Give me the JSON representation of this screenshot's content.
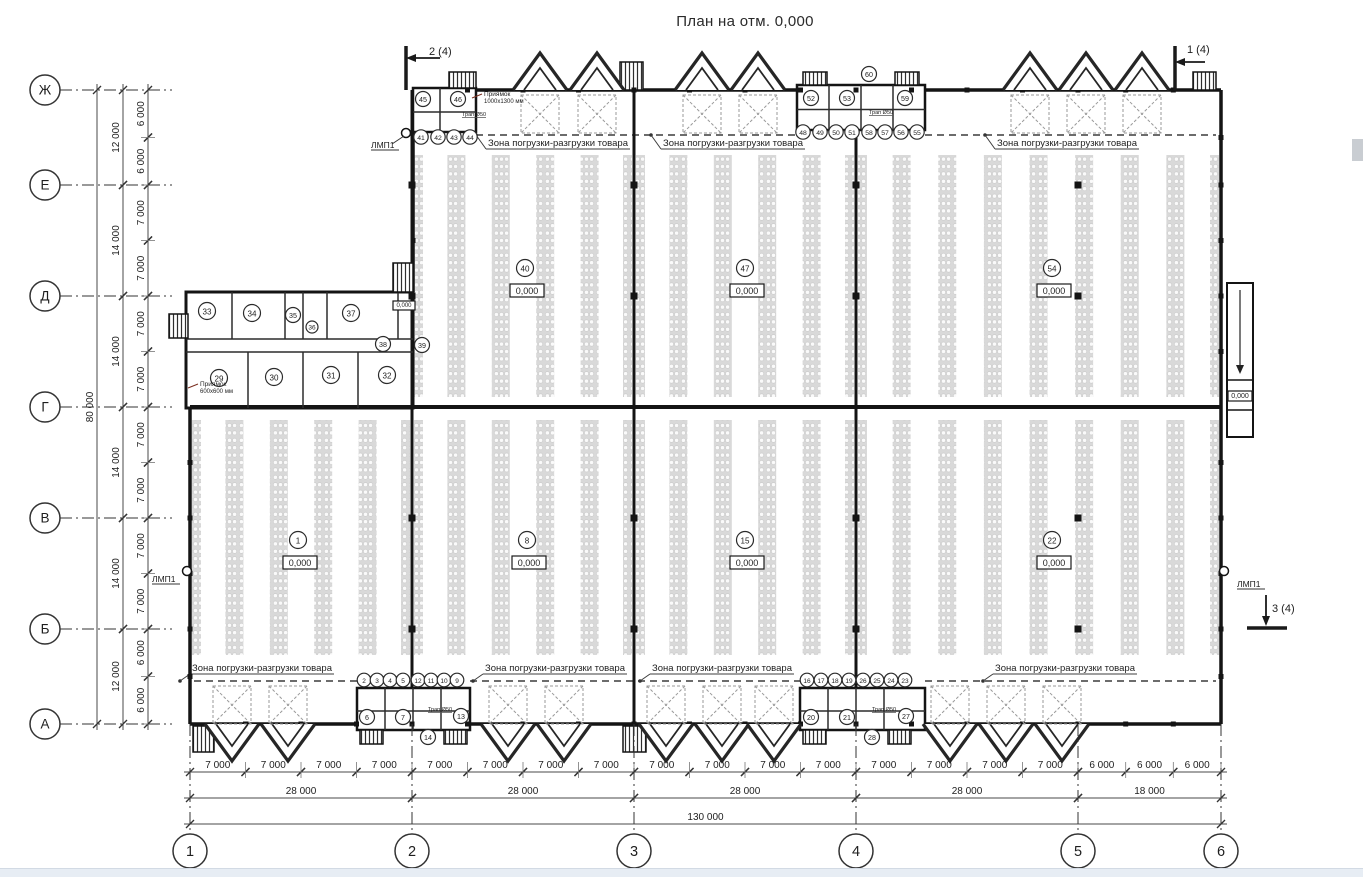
{
  "title": "План на отм. 0,000",
  "zone_label": "Зона погрузки-разгрузки товара",
  "letter_axes": [
    {
      "label": "Ж",
      "y": 90
    },
    {
      "label": "Е",
      "y": 185
    },
    {
      "label": "Д",
      "y": 296
    },
    {
      "label": "Г",
      "y": 407
    },
    {
      "label": "В",
      "y": 518
    },
    {
      "label": "Б",
      "y": 629
    },
    {
      "label": "А",
      "y": 724
    }
  ],
  "number_axes": [
    {
      "label": "1",
      "x": 190
    },
    {
      "label": "2",
      "x": 412
    },
    {
      "label": "3",
      "x": 634
    },
    {
      "label": "4",
      "x": 856
    },
    {
      "label": "5",
      "x": 1078
    },
    {
      "label": "6",
      "x": 1221
    }
  ],
  "dim_left_minor": [
    {
      "text": "6 000",
      "a": 90,
      "b": 137.5
    },
    {
      "text": "6 000",
      "a": 137.5,
      "b": 185
    },
    {
      "text": "7 000",
      "a": 185,
      "b": 240.5
    },
    {
      "text": "7 000",
      "a": 240.5,
      "b": 296
    },
    {
      "text": "7 000",
      "a": 296,
      "b": 351.5
    },
    {
      "text": "7 000",
      "a": 351.5,
      "b": 407
    },
    {
      "text": "7 000",
      "a": 407,
      "b": 462.5
    },
    {
      "text": "7 000",
      "a": 462.5,
      "b": 518
    },
    {
      "text": "7 000",
      "a": 518,
      "b": 573.5
    },
    {
      "text": "7 000",
      "a": 573.5,
      "b": 629
    },
    {
      "text": "6 000",
      "a": 629,
      "b": 676.5
    },
    {
      "text": "6 000",
      "a": 676.5,
      "b": 724
    }
  ],
  "dim_left_major": [
    {
      "text": "12 000",
      "a": 90,
      "b": 185
    },
    {
      "text": "14 000",
      "a": 185,
      "b": 296
    },
    {
      "text": "14 000",
      "a": 296,
      "b": 407
    },
    {
      "text": "14 000",
      "a": 407,
      "b": 518
    },
    {
      "text": "14 000",
      "a": 518,
      "b": 629
    },
    {
      "text": "12 000",
      "a": 629,
      "b": 724
    }
  ],
  "dim_left_total": {
    "text": "80 000",
    "a": 90,
    "b": 724
  },
  "dim_bottom_minor": [
    {
      "text": "7 000",
      "a": 190,
      "b": 245.5
    },
    {
      "text": "7 000",
      "a": 245.5,
      "b": 301
    },
    {
      "text": "7 000",
      "a": 301,
      "b": 356.5
    },
    {
      "text": "7 000",
      "a": 356.5,
      "b": 412
    },
    {
      "text": "7 000",
      "a": 412,
      "b": 467.5
    },
    {
      "text": "7 000",
      "a": 467.5,
      "b": 523
    },
    {
      "text": "7 000",
      "a": 523,
      "b": 578.5
    },
    {
      "text": "7 000",
      "a": 578.5,
      "b": 634
    },
    {
      "text": "7 000",
      "a": 634,
      "b": 689.5
    },
    {
      "text": "7 000",
      "a": 689.5,
      "b": 745
    },
    {
      "text": "7 000",
      "a": 745,
      "b": 800.5
    },
    {
      "text": "7 000",
      "a": 800.5,
      "b": 856
    },
    {
      "text": "7 000",
      "a": 856,
      "b": 911.5
    },
    {
      "text": "7 000",
      "a": 911.5,
      "b": 967
    },
    {
      "text": "7 000",
      "a": 967,
      "b": 1022.5
    },
    {
      "text": "7 000",
      "a": 1022.5,
      "b": 1078
    },
    {
      "text": "6 000",
      "a": 1078,
      "b": 1125.7
    },
    {
      "text": "6 000",
      "a": 1125.7,
      "b": 1173.3
    },
    {
      "text": "6 000",
      "a": 1173.3,
      "b": 1221
    }
  ],
  "dim_bottom_major": [
    {
      "text": "28 000",
      "a": 190,
      "b": 412
    },
    {
      "text": "28 000",
      "a": 412,
      "b": 634
    },
    {
      "text": "28 000",
      "a": 634,
      "b": 856
    },
    {
      "text": "28 000",
      "a": 856,
      "b": 1078
    },
    {
      "text": "18 000",
      "a": 1078,
      "b": 1221
    }
  ],
  "dim_bottom_total": {
    "text": "130 000",
    "a": 190,
    "b": 1221
  },
  "zones": [
    {
      "x": 558,
      "y": 146,
      "side": "top"
    },
    {
      "x": 733,
      "y": 146,
      "side": "top"
    },
    {
      "x": 1067,
      "y": 146,
      "side": "top"
    },
    {
      "x": 262,
      "y": 671,
      "side": "bottom"
    },
    {
      "x": 555,
      "y": 671,
      "side": "bottom"
    },
    {
      "x": 722,
      "y": 671,
      "side": "bottom"
    },
    {
      "x": 1065,
      "y": 671,
      "side": "bottom"
    }
  ],
  "rooms": [
    {
      "n": "1",
      "x": 298,
      "y": 540,
      "r": 8.5
    },
    {
      "n": "8",
      "x": 527,
      "y": 540,
      "r": 8.5
    },
    {
      "n": "15",
      "x": 745,
      "y": 540,
      "r": 8.5
    },
    {
      "n": "22",
      "x": 1052,
      "y": 540,
      "r": 8.5
    },
    {
      "n": "40",
      "x": 525,
      "y": 268,
      "r": 8.5
    },
    {
      "n": "47",
      "x": 745,
      "y": 268,
      "r": 8.5
    },
    {
      "n": "54",
      "x": 1052,
      "y": 268,
      "r": 8.5
    },
    {
      "n": "33",
      "x": 207,
      "y": 311,
      "r": 8.5
    },
    {
      "n": "34",
      "x": 252,
      "y": 313,
      "r": 8.5
    },
    {
      "n": "35",
      "x": 293,
      "y": 315,
      "r": 7.5
    },
    {
      "n": "36",
      "x": 312,
      "y": 327,
      "r": 6
    },
    {
      "n": "37",
      "x": 351,
      "y": 313,
      "r": 8.5
    },
    {
      "n": "38",
      "x": 383,
      "y": 344,
      "r": 7.5
    },
    {
      "n": "39",
      "x": 422,
      "y": 345,
      "r": 7.5
    },
    {
      "n": "29",
      "x": 219,
      "y": 378,
      "r": 8.5
    },
    {
      "n": "30",
      "x": 274,
      "y": 377,
      "r": 8.5
    },
    {
      "n": "31",
      "x": 331,
      "y": 375,
      "r": 8.5
    },
    {
      "n": "32",
      "x": 387,
      "y": 375,
      "r": 8.5
    },
    {
      "n": "45",
      "x": 423,
      "y": 99,
      "r": 7.5
    },
    {
      "n": "46",
      "x": 458,
      "y": 99,
      "r": 7.5
    },
    {
      "n": "41",
      "x": 421,
      "y": 137,
      "r": 7.2
    },
    {
      "n": "42",
      "x": 438,
      "y": 137,
      "r": 7.2
    },
    {
      "n": "43",
      "x": 454,
      "y": 137,
      "r": 7.2
    },
    {
      "n": "44",
      "x": 470,
      "y": 137,
      "r": 7.2
    },
    {
      "n": "52",
      "x": 811,
      "y": 98,
      "r": 7.5
    },
    {
      "n": "53",
      "x": 847,
      "y": 98,
      "r": 7.5
    },
    {
      "n": "59",
      "x": 905,
      "y": 98,
      "r": 7.5
    },
    {
      "n": "60",
      "x": 869,
      "y": 74,
      "r": 7.5
    },
    {
      "n": "48",
      "x": 803,
      "y": 132,
      "r": 7.2
    },
    {
      "n": "49",
      "x": 820,
      "y": 132,
      "r": 7.2
    },
    {
      "n": "50",
      "x": 836,
      "y": 132,
      "r": 7.2
    },
    {
      "n": "51",
      "x": 852,
      "y": 132,
      "r": 7.2
    },
    {
      "n": "58",
      "x": 869,
      "y": 132,
      "r": 7.2
    },
    {
      "n": "57",
      "x": 885,
      "y": 132,
      "r": 7.2
    },
    {
      "n": "56",
      "x": 901,
      "y": 132,
      "r": 7.2
    },
    {
      "n": "55",
      "x": 917,
      "y": 132,
      "r": 7.2
    },
    {
      "n": "2",
      "x": 364,
      "y": 680,
      "r": 6.8
    },
    {
      "n": "3",
      "x": 377,
      "y": 680,
      "r": 6.8
    },
    {
      "n": "4",
      "x": 390,
      "y": 680,
      "r": 6.8
    },
    {
      "n": "5",
      "x": 403,
      "y": 680,
      "r": 6.8
    },
    {
      "n": "12",
      "x": 418,
      "y": 680,
      "r": 6.8
    },
    {
      "n": "11",
      "x": 431,
      "y": 680,
      "r": 6.8
    },
    {
      "n": "10",
      "x": 444,
      "y": 680,
      "r": 6.8
    },
    {
      "n": "9",
      "x": 457,
      "y": 680,
      "r": 6.8
    },
    {
      "n": "6",
      "x": 367,
      "y": 717,
      "r": 7.5
    },
    {
      "n": "7",
      "x": 403,
      "y": 717,
      "r": 7.5
    },
    {
      "n": "13",
      "x": 461,
      "y": 716,
      "r": 7.5
    },
    {
      "n": "14",
      "x": 428,
      "y": 737,
      "r": 7.5
    },
    {
      "n": "16",
      "x": 807,
      "y": 680,
      "r": 6.8
    },
    {
      "n": "17",
      "x": 821,
      "y": 680,
      "r": 6.8
    },
    {
      "n": "18",
      "x": 835,
      "y": 680,
      "r": 6.8
    },
    {
      "n": "19",
      "x": 849,
      "y": 680,
      "r": 6.8
    },
    {
      "n": "26",
      "x": 863,
      "y": 680,
      "r": 6.8
    },
    {
      "n": "25",
      "x": 877,
      "y": 680,
      "r": 6.8
    },
    {
      "n": "24",
      "x": 891,
      "y": 680,
      "r": 6.8
    },
    {
      "n": "23",
      "x": 905,
      "y": 680,
      "r": 6.8
    },
    {
      "n": "20",
      "x": 811,
      "y": 717,
      "r": 7.5
    },
    {
      "n": "21",
      "x": 847,
      "y": 717,
      "r": 7.5
    },
    {
      "n": "27",
      "x": 906,
      "y": 716,
      "r": 7.5
    },
    {
      "n": "28",
      "x": 872,
      "y": 737,
      "r": 7.5
    }
  ],
  "elevations": [
    {
      "text": "0,000",
      "x": 300,
      "y": 556,
      "w": 34,
      "h": 13,
      "fs": 9
    },
    {
      "text": "0,000",
      "x": 529,
      "y": 556,
      "w": 34,
      "h": 13,
      "fs": 9
    },
    {
      "text": "0,000",
      "x": 747,
      "y": 556,
      "w": 34,
      "h": 13,
      "fs": 9
    },
    {
      "text": "0,000",
      "x": 1054,
      "y": 556,
      "w": 34,
      "h": 13,
      "fs": 9
    },
    {
      "text": "0,000",
      "x": 527,
      "y": 284,
      "w": 34,
      "h": 13,
      "fs": 9
    },
    {
      "text": "0,000",
      "x": 747,
      "y": 284,
      "w": 34,
      "h": 13,
      "fs": 9
    },
    {
      "text": "0,000",
      "x": 1054,
      "y": 284,
      "w": 34,
      "h": 13,
      "fs": 9
    },
    {
      "text": "0,000",
      "x": 1240,
      "y": 391,
      "w": 24,
      "h": 10,
      "fs": 7
    },
    {
      "text": "0,000",
      "x": 404,
      "y": 301,
      "w": 22,
      "h": 9,
      "fs": 6
    }
  ],
  "lmp_labels": [
    {
      "text": "ЛМП1",
      "x": 371,
      "y": 148
    },
    {
      "text": "ЛМП1",
      "x": 152,
      "y": 582
    },
    {
      "text": "ЛМП1",
      "x": 1237,
      "y": 587
    }
  ],
  "section_marks": [
    {
      "text": "2 (4)",
      "x": 424,
      "y": 55
    },
    {
      "text": "1 (4)",
      "x": 1197,
      "y": 53
    },
    {
      "text": "3 (4)",
      "x": 1279,
      "y": 612
    }
  ],
  "pit_labels": [
    {
      "line1": "Приямок",
      "line2": "1000х1300 мм",
      "x": 484,
      "y": 96
    },
    {
      "line1": "Приямок",
      "line2": "600х600 мм",
      "x": 200,
      "y": 386
    }
  ],
  "drain_labels": [
    {
      "text": "Трап Ø50",
      "x": 462,
      "y": 116
    },
    {
      "text": "Трап Ø50",
      "x": 869,
      "y": 114
    },
    {
      "text": "Трап Ø50",
      "x": 428,
      "y": 711
    },
    {
      "text": "Трап Ø50",
      "x": 872,
      "y": 711
    }
  ]
}
